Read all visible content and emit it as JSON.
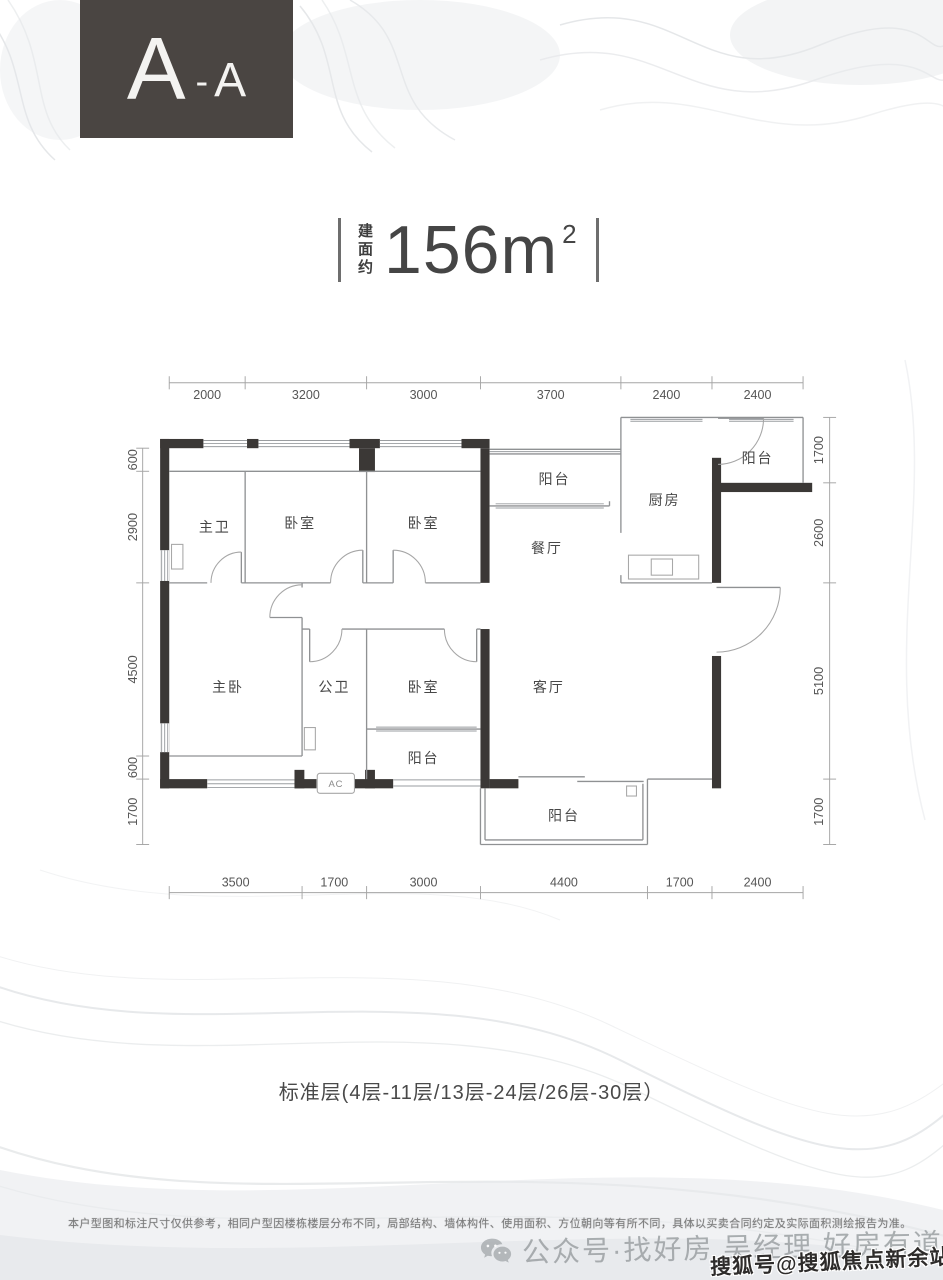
{
  "badge": {
    "label_large": "A",
    "dash": "-",
    "label_small": "A"
  },
  "area_label": {
    "prefix_vertical": "建面约",
    "value": "156m",
    "superscript": "2"
  },
  "plan": {
    "rooms": [
      {
        "label": "主卫"
      },
      {
        "label": "卧室"
      },
      {
        "label": "卧室"
      },
      {
        "label": "阳台"
      },
      {
        "label": "餐厅"
      },
      {
        "label": "厨房"
      },
      {
        "label": "阳台"
      },
      {
        "label": "主卧"
      },
      {
        "label": "公卫"
      },
      {
        "label": "卧室"
      },
      {
        "label": "客厅"
      },
      {
        "label": "阳台"
      },
      {
        "label": "阳台"
      }
    ],
    "ac_label": "AC",
    "dimensions_mm": {
      "top": [
        2000,
        3200,
        3000,
        3700,
        2400,
        2400
      ],
      "bottom": [
        3500,
        1700,
        3000,
        4400,
        1700,
        2400
      ],
      "left": [
        600,
        2900,
        4500,
        600,
        1700
      ],
      "right": [
        1700,
        2600,
        5100,
        1700
      ]
    }
  },
  "floor_note": "标准层(4层-11层/13层-24层/26层-30层）",
  "disclaimer": "本户型图和标注尺寸仅供参考，相同户型因楼栋楼层分布不同，局部结构、墙体构件、使用面积、方位朝向等有所不同，具体以买卖合同约定及实际面积测绘报告为准。",
  "watermark": {
    "text": "公众号·找好房 吴经理 好房有道"
  },
  "publisher_stamp": "搜狐号@搜狐焦点新余站",
  "colors": {
    "wall": "#3b3836",
    "badge_bg": "#4a4542"
  }
}
